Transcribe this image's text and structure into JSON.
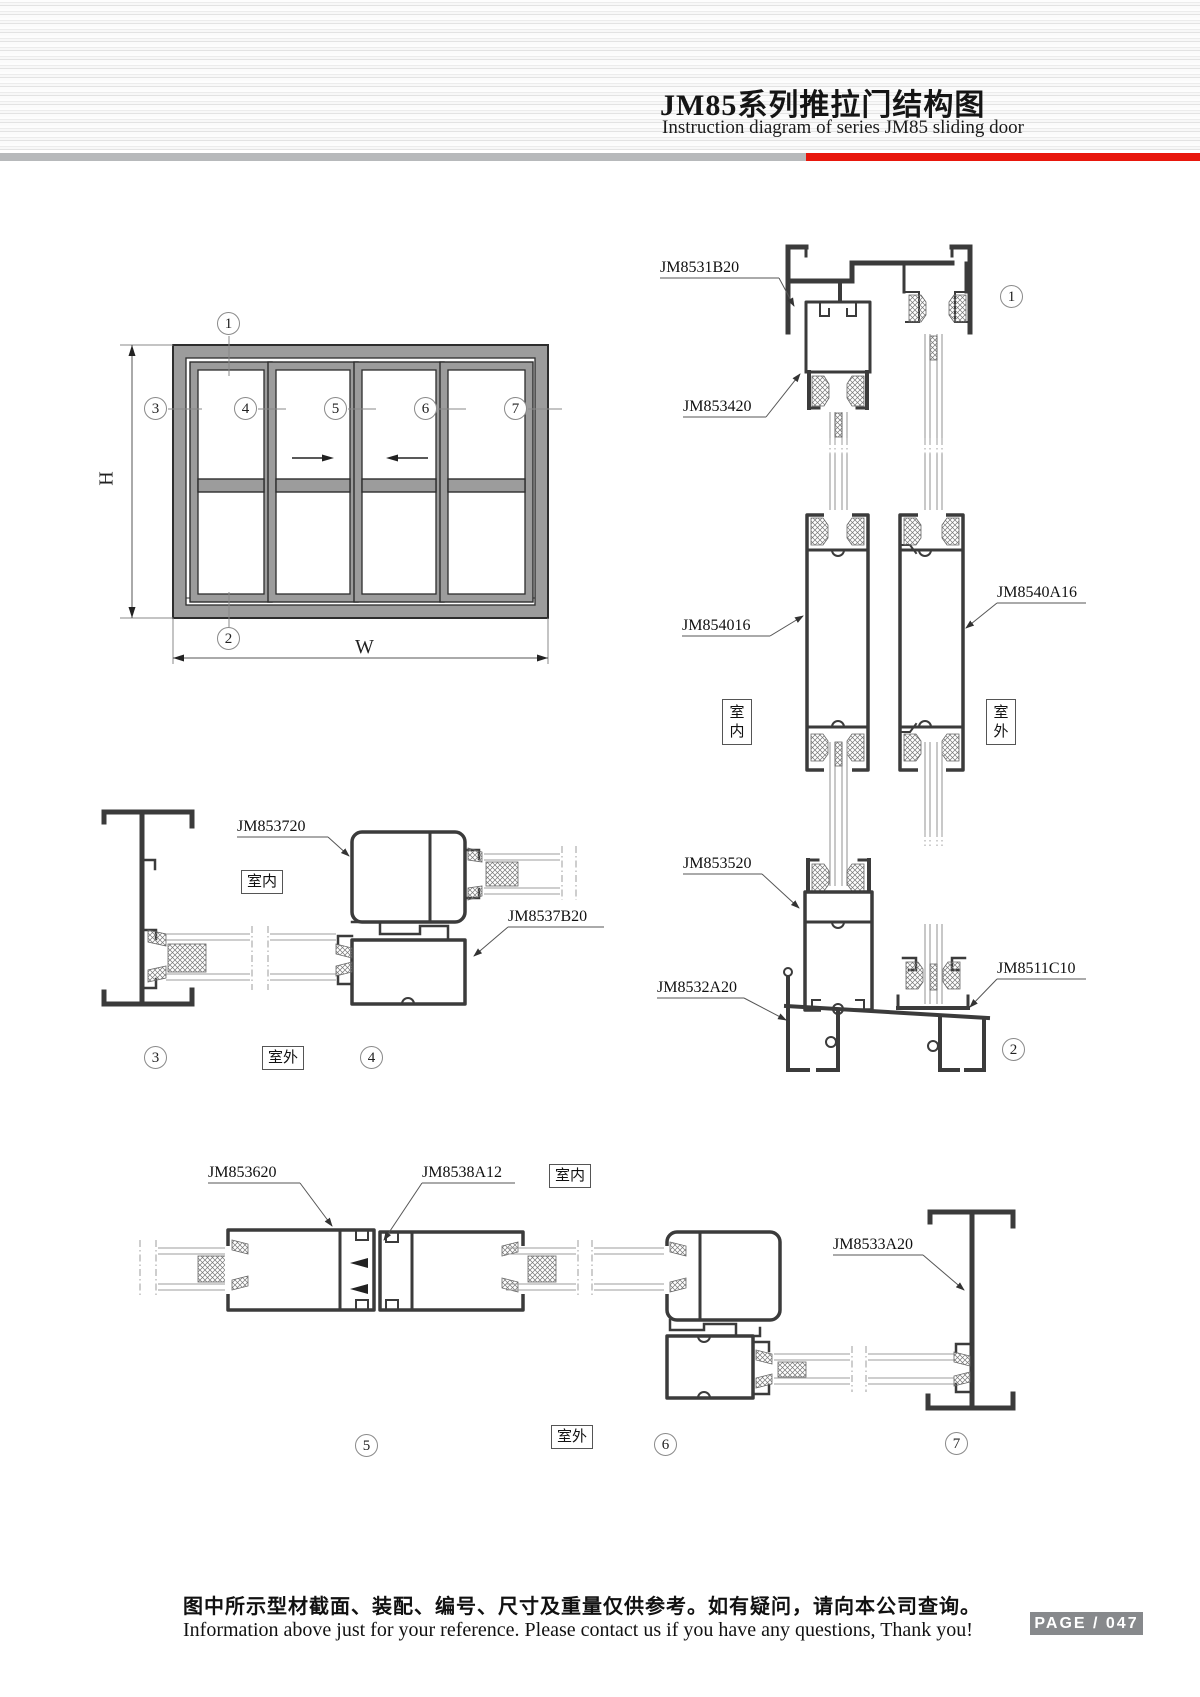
{
  "header": {
    "title": "JM85系列推拉门结构图",
    "subtitle": "Instruction diagram of series JM85 sliding door"
  },
  "elevation": {
    "dim_h": "H",
    "dim_w": "W"
  },
  "callouts": {
    "c1": "1",
    "c2": "2",
    "c3": "3",
    "c4": "4",
    "c5": "5",
    "c6": "6",
    "c7": "7"
  },
  "zones": {
    "indoor": "室内",
    "outdoor": "室外"
  },
  "parts": {
    "jm8531b20": "JM8531B20",
    "jm853420": "JM853420",
    "jm854016": "JM854016",
    "jm8540a16": "JM8540A16",
    "jm853520": "JM853520",
    "jm8532a20": "JM8532A20",
    "jm8511c10": "JM8511C10",
    "jm853720": "JM853720",
    "jm8537b20": "JM8537B20",
    "jm853620": "JM853620",
    "jm8538a12": "JM8538A12",
    "jm8533a20": "JM8533A20"
  },
  "footer": {
    "note_cn": "图中所示型材截面、装配、编号、尺寸及重量仅供参考。如有疑问，请向本公司查询。",
    "note_en": "Information above just for your reference. Please contact us if you have any questions, Thank you!",
    "page": "PAGE / 047"
  }
}
